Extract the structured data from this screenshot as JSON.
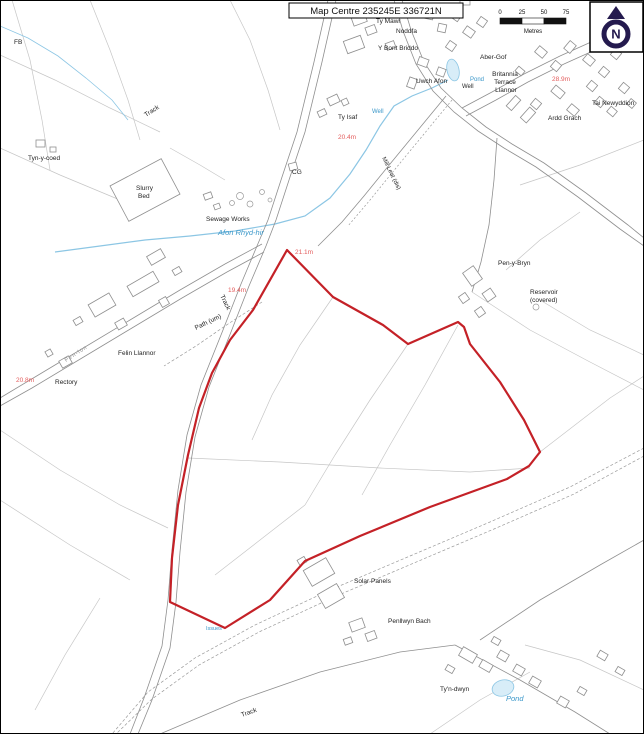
{
  "title": {
    "text": "Map Centre 235245E 336721N"
  },
  "scale_bar": {
    "ticks": [
      "0",
      "25",
      "50",
      "75"
    ],
    "unit": "Metres"
  },
  "north_arrow": {
    "letter": "N"
  },
  "colors": {
    "boundary": "#c42127",
    "spot_height": "#e35d5d",
    "water_text": "#3a97c9",
    "water_line": "#8cc6e4",
    "pond_fill": "#d8edf8",
    "road": "#8f8f8f",
    "field": "#c6c6c6",
    "building": "#8f8f8f",
    "label": "#1f1f1f",
    "north": "#241a4e"
  },
  "boundary": {
    "points": "287,250 333,297 383,325 408,344 458,322 464,327 470,344 500,382 524,420 540,452 529,466 507,479 430,507 360,536 305,561 270,600 225,628 170,602 172,558 178,505 188,455 199,408 212,373 230,340 253,310"
  },
  "map_labels": [
    {
      "t": "FB",
      "x": 14,
      "y": 44
    },
    {
      "t": "Tyn-y-coed",
      "x": 28,
      "y": 160
    },
    {
      "t": "Track",
      "x": 146,
      "y": 117,
      "r": -33
    },
    {
      "t": "Slurry",
      "x": 136,
      "y": 190
    },
    {
      "t": "Bed",
      "x": 138,
      "y": 198
    },
    {
      "t": "Sewage Works",
      "x": 206,
      "y": 221
    },
    {
      "t": "Afon Rhyd-hir",
      "x": 218,
      "y": 235,
      "c": "#3a97c9",
      "i": true,
      "s": 7.5
    },
    {
      "t": "Track",
      "x": 220,
      "y": 296,
      "r": 64
    },
    {
      "t": "Path (um)",
      "x": 196,
      "y": 330,
      "r": -26
    },
    {
      "t": "Pen-lon",
      "x": 66,
      "y": 362,
      "r": -33,
      "c": "#8a8a8a",
      "s": 5.5,
      "ls": 1
    },
    {
      "t": "Rectory",
      "x": 55,
      "y": 384
    },
    {
      "t": "20.8m",
      "x": 16,
      "y": 382,
      "c": "#e35d5d"
    },
    {
      "t": "Felin Llannor",
      "x": 118,
      "y": 355
    },
    {
      "t": "19.4m",
      "x": 228,
      "y": 292,
      "c": "#e35d5d"
    },
    {
      "t": "21.1m",
      "x": 295,
      "y": 254,
      "c": "#e35d5d"
    },
    {
      "t": "20.4m",
      "x": 338,
      "y": 139,
      "c": "#e35d5d"
    },
    {
      "t": "Ty Isaf",
      "x": 338,
      "y": 119
    },
    {
      "t": "Well",
      "x": 372,
      "y": 113,
      "c": "#3a97c9",
      "s": 6
    },
    {
      "t": "Mill Leat (dis)",
      "x": 382,
      "y": 158,
      "r": 64,
      "s": 6
    },
    {
      "t": "CG",
      "x": 292,
      "y": 174
    },
    {
      "t": "Uwch Afon",
      "x": 416,
      "y": 83
    },
    {
      "t": "Ty Mawr",
      "x": 376,
      "y": 23
    },
    {
      "t": "Noddfa",
      "x": 396,
      "y": 33
    },
    {
      "t": "Y Bont Briddo",
      "x": 378,
      "y": 50
    },
    {
      "t": "Penlleiniau",
      "x": 397,
      "y": 11
    },
    {
      "t": "Aber-Gof",
      "x": 480,
      "y": 59
    },
    {
      "t": "Pond",
      "x": 470,
      "y": 81,
      "c": "#3a97c9",
      "s": 6
    },
    {
      "t": "Well",
      "x": 462,
      "y": 88,
      "s": 6
    },
    {
      "t": "Britannia",
      "x": 505,
      "y": 76,
      "a": "middle"
    },
    {
      "t": "Terrace",
      "x": 505,
      "y": 84,
      "a": "middle"
    },
    {
      "t": "Llannor",
      "x": 506,
      "y": 92,
      "a": "middle"
    },
    {
      "t": "28.9m",
      "x": 552,
      "y": 81,
      "c": "#e35d5d"
    },
    {
      "t": "Tai Newyddion",
      "x": 592,
      "y": 105
    },
    {
      "t": "Ardd Grach",
      "x": 548,
      "y": 120
    },
    {
      "t": "Pen-y-Bryn",
      "x": 498,
      "y": 265
    },
    {
      "t": "Reservoir",
      "x": 530,
      "y": 294
    },
    {
      "t": "(covered)",
      "x": 530,
      "y": 302
    },
    {
      "t": "Solar Panels",
      "x": 354,
      "y": 583
    },
    {
      "t": "Penllwyn Bach",
      "x": 388,
      "y": 623
    },
    {
      "t": "Issues",
      "x": 206,
      "y": 630,
      "c": "#3a97c9",
      "s": 5.5
    },
    {
      "t": "Ty'n-dwyn",
      "x": 440,
      "y": 691
    },
    {
      "t": "Pond",
      "x": 506,
      "y": 701,
      "c": "#3a97c9",
      "i": true,
      "s": 7.5
    },
    {
      "t": "Track",
      "x": 242,
      "y": 717,
      "r": -20
    }
  ],
  "buildings": [
    [
      352,
      14,
      14,
      10,
      -20
    ],
    [
      366,
      26,
      10,
      8,
      -20
    ],
    [
      345,
      38,
      18,
      13,
      -20
    ],
    [
      386,
      42,
      9,
      7,
      -20
    ],
    [
      424,
      6,
      10,
      13,
      12
    ],
    [
      438,
      24,
      8,
      8,
      12
    ],
    [
      452,
      10,
      9,
      10,
      35
    ],
    [
      464,
      28,
      10,
      8,
      35
    ],
    [
      447,
      42,
      8,
      8,
      35
    ],
    [
      478,
      18,
      8,
      8,
      35
    ],
    [
      460,
      0,
      10,
      5,
      0
    ],
    [
      418,
      58,
      10,
      8,
      20
    ],
    [
      437,
      68,
      8,
      8,
      20
    ],
    [
      408,
      78,
      8,
      10,
      20
    ],
    [
      536,
      48,
      10,
      8,
      40
    ],
    [
      552,
      62,
      8,
      8,
      40
    ],
    [
      566,
      42,
      8,
      10,
      40
    ],
    [
      584,
      56,
      10,
      8,
      40
    ],
    [
      600,
      68,
      8,
      8,
      40
    ],
    [
      588,
      82,
      8,
      8,
      40
    ],
    [
      612,
      50,
      8,
      8,
      40
    ],
    [
      552,
      88,
      12,
      8,
      40
    ],
    [
      532,
      100,
      8,
      8,
      40
    ],
    [
      568,
      106,
      10,
      8,
      40
    ],
    [
      596,
      98,
      8,
      8,
      40
    ],
    [
      620,
      84,
      8,
      8,
      40
    ],
    [
      516,
      68,
      8,
      6,
      40
    ],
    [
      510,
      96,
      7,
      14,
      42
    ],
    [
      524,
      108,
      8,
      14,
      42
    ],
    [
      608,
      108,
      8,
      7,
      40
    ],
    [
      628,
      100,
      7,
      7,
      40
    ],
    [
      466,
      268,
      13,
      16,
      -35
    ],
    [
      484,
      290,
      10,
      10,
      -35
    ],
    [
      460,
      294,
      8,
      8,
      -35
    ],
    [
      476,
      308,
      8,
      8,
      -35
    ],
    [
      90,
      298,
      24,
      14,
      -30
    ],
    [
      128,
      278,
      30,
      12,
      -30
    ],
    [
      148,
      252,
      16,
      10,
      -30
    ],
    [
      116,
      320,
      10,
      8,
      -30
    ],
    [
      160,
      298,
      8,
      8,
      -30
    ],
    [
      74,
      318,
      8,
      6,
      -30
    ],
    [
      173,
      268,
      8,
      6,
      -30
    ],
    [
      60,
      358,
      11,
      8,
      -30
    ],
    [
      46,
      350,
      6,
      6,
      -30
    ],
    [
      328,
      96,
      11,
      8,
      -25
    ],
    [
      318,
      110,
      8,
      6,
      -25
    ],
    [
      342,
      99,
      6,
      6,
      -25
    ],
    [
      289,
      163,
      8,
      7,
      -15
    ],
    [
      204,
      193,
      8,
      6,
      -20
    ],
    [
      214,
      204,
      6,
      5,
      -20
    ],
    [
      116,
      170,
      58,
      40,
      -28
    ],
    [
      306,
      563,
      26,
      18,
      -30
    ],
    [
      320,
      588,
      22,
      16,
      -30
    ],
    [
      298,
      558,
      8,
      6,
      -30
    ],
    [
      350,
      620,
      14,
      10,
      -20
    ],
    [
      366,
      632,
      10,
      8,
      -20
    ],
    [
      344,
      638,
      8,
      6,
      -20
    ],
    [
      460,
      650,
      16,
      10,
      30
    ],
    [
      480,
      662,
      12,
      8,
      30
    ],
    [
      498,
      652,
      10,
      8,
      30
    ],
    [
      514,
      666,
      10,
      8,
      30
    ],
    [
      530,
      678,
      10,
      8,
      30
    ],
    [
      492,
      638,
      8,
      6,
      30
    ],
    [
      446,
      666,
      8,
      6,
      30
    ],
    [
      558,
      698,
      10,
      8,
      30
    ],
    [
      578,
      688,
      8,
      6,
      30
    ],
    [
      36,
      140,
      9,
      7,
      0
    ],
    [
      50,
      147,
      6,
      5,
      0
    ],
    [
      598,
      652,
      9,
      7,
      30
    ],
    [
      616,
      668,
      8,
      6,
      30
    ]
  ]
}
